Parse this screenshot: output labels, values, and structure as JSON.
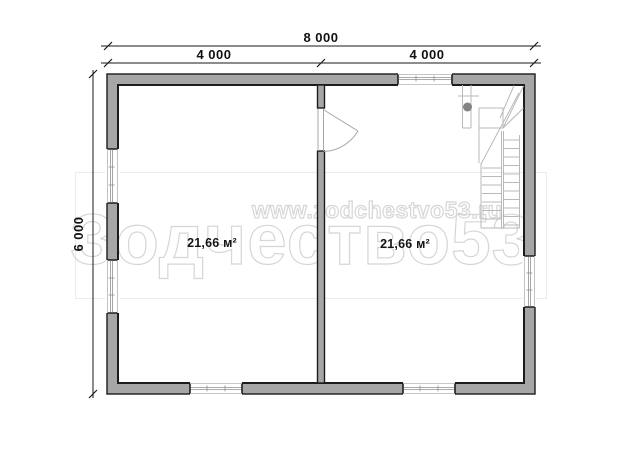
{
  "plan": {
    "type": "floor-plan",
    "units": "mm",
    "overall": {
      "width_mm": 8000,
      "height_mm": 6000
    }
  },
  "dimensions": {
    "overall_width": "8 000",
    "half_width_left": "4 000",
    "half_width_right": "4 000",
    "overall_height": "6 000"
  },
  "rooms": [
    {
      "name": "left-room",
      "area": "21,66 м²"
    },
    {
      "name": "right-room",
      "area": "21,66 м²"
    }
  ],
  "watermark": {
    "url": "www.zodchestvo53.ru",
    "brand": "Зодчество53"
  },
  "colors": {
    "wall_fill": "#a6a6a6",
    "wall_outline": "#1c1c1c",
    "window_lines": "#8f8f8f",
    "stair_lines": "#b9b9b9",
    "newel_post": "#838383",
    "dimension_ink": "#1a1a1a",
    "watermark": "#d6d6d6",
    "background": "#ffffff"
  }
}
